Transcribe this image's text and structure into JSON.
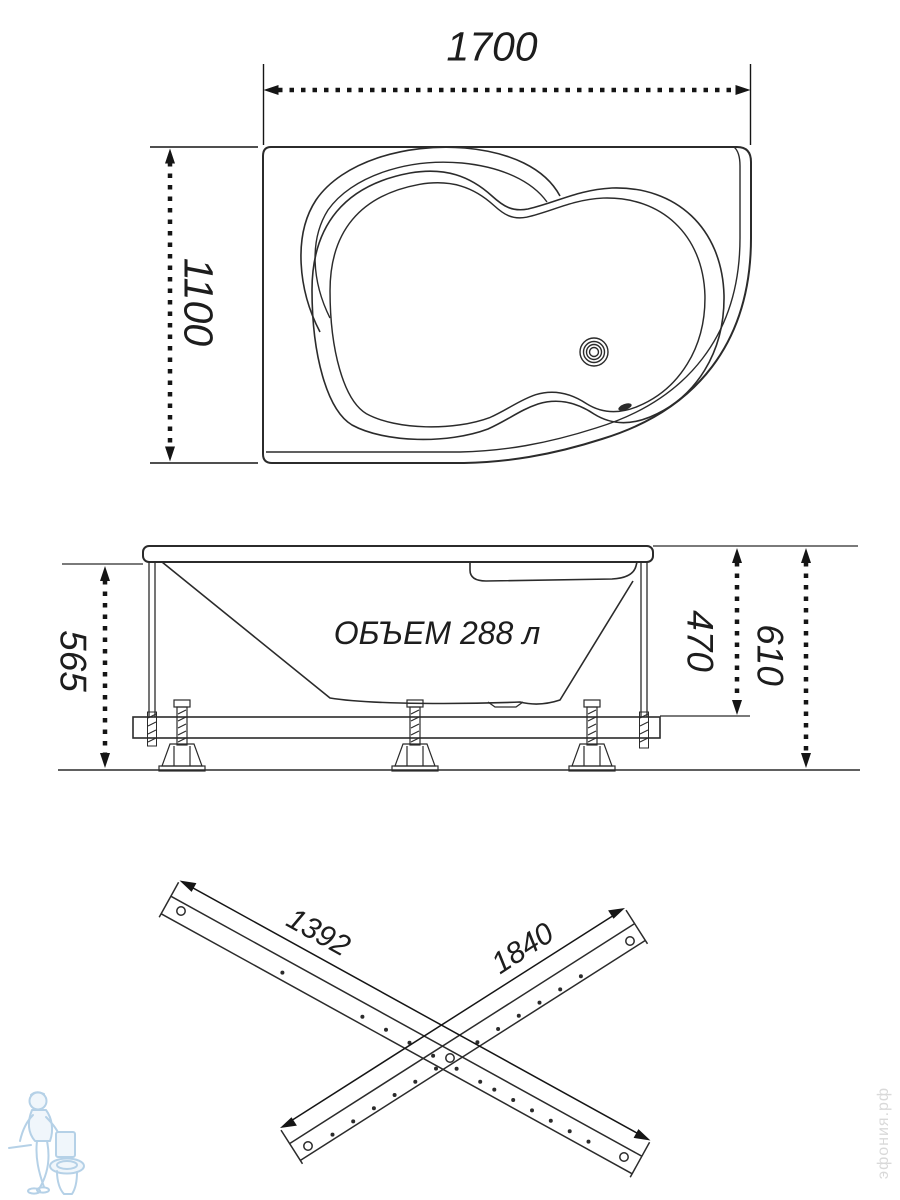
{
  "drawing": {
    "plan_view": {
      "width": "1700",
      "depth": "1100"
    },
    "side_view": {
      "volume": "ОБЪЕМ 288 л",
      "height_underside": "565",
      "height_rim_to_frame": "470",
      "height_total": "610"
    },
    "frame_rails": {
      "rail_short": "1392",
      "rail_long": "1840"
    },
    "watermark": {
      "site": "эфония.рф"
    },
    "colors": {
      "line": "#2b2b2b",
      "dimension": "#151515",
      "logo_blue": "#a9c9e3"
    }
  }
}
